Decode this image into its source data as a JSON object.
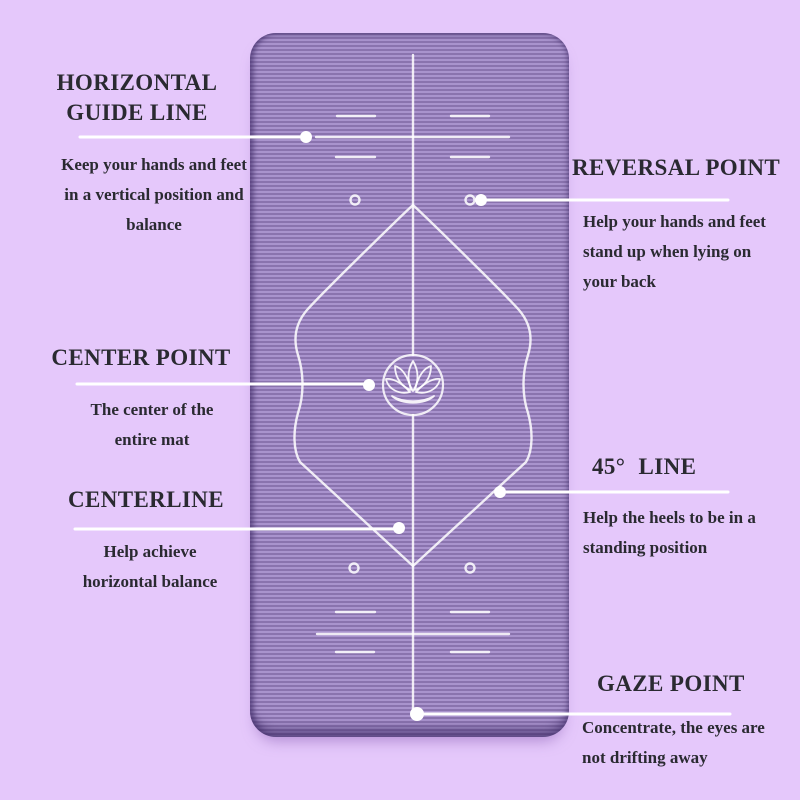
{
  "theme": {
    "background": "#e5c8fb",
    "mat_stripe_dark": "#8a73ae",
    "mat_stripe_light": "#a993cd",
    "marking_white": "#ffffff",
    "text_color": "#2a2a31"
  },
  "icons": {
    "center_emblem": "lotus-icon",
    "callout_marker": "callout-dot"
  },
  "annotations": {
    "horizontal_guide_line": {
      "title": [
        "HORIZONTAL",
        "GUIDE LINE"
      ],
      "description": [
        "Keep your hands and feet",
        "in a vertical position and",
        "balance"
      ]
    },
    "reversal_point": {
      "title": "REVERSAL POINT",
      "description": [
        "Help your hands and feet",
        "stand up when lying on",
        "your back"
      ]
    },
    "center_point": {
      "title": "CENTER POINT",
      "description": [
        "The center of the",
        "entire mat"
      ]
    },
    "centerline": {
      "title": "CENTERLINE",
      "description": [
        "Help achieve",
        "horizontal balance"
      ]
    },
    "line_45": {
      "title": "45° LINE",
      "description": [
        "Help the heels to be in a",
        "standing position"
      ]
    },
    "gaze_point": {
      "title": "GAZE POINT",
      "description": [
        "Concentrate, the eyes are",
        "not drifting away"
      ]
    }
  }
}
